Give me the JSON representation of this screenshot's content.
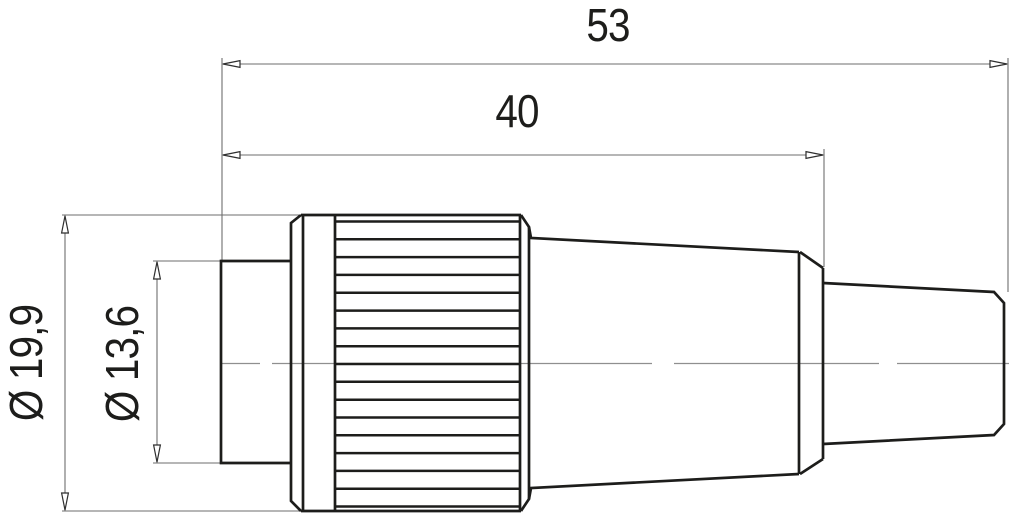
{
  "drawing": {
    "kind": "technical dimension drawing",
    "subject": "circular cable connector, side view",
    "background_color": "#ffffff",
    "outline_color": "#1d1d1b",
    "dimension_line_color": "#6e6e6e",
    "centerline_color": "#8f8f8f",
    "text_color": "#1d1d1b"
  },
  "dimensions": {
    "total_length": "53",
    "grip_length": "40",
    "outer_diameter": "Ø 19,9",
    "front_diameter": "Ø 13,6"
  }
}
